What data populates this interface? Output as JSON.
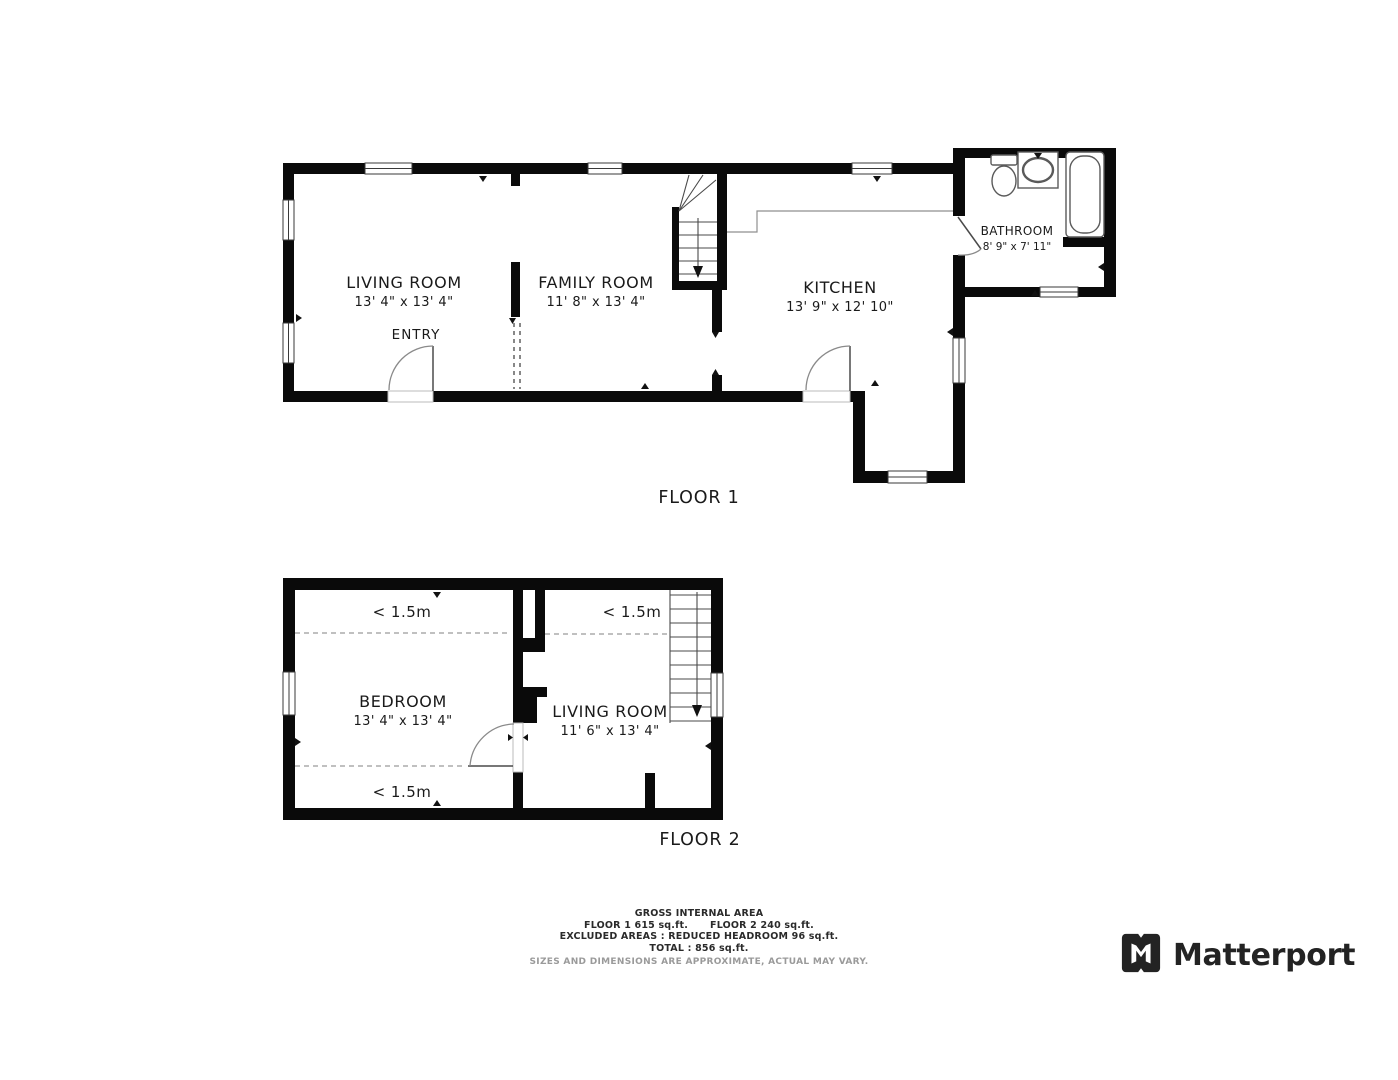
{
  "floor1": {
    "label": "FLOOR 1",
    "rooms": {
      "living_room": {
        "name": "LIVING ROOM",
        "dims": "13' 4\" x 13' 4\""
      },
      "entry": {
        "name": "ENTRY"
      },
      "family_room": {
        "name": "FAMILY ROOM",
        "dims": "11' 8\" x 13' 4\""
      },
      "kitchen": {
        "name": "KITCHEN",
        "dims": "13' 9\" x 12' 10\""
      },
      "bathroom": {
        "name": "BATHROOM",
        "dims": "8' 9\" x 7' 11\""
      }
    }
  },
  "floor2": {
    "label": "FLOOR 2",
    "rooms": {
      "bedroom": {
        "name": "BEDROOM",
        "dims": "13' 4\" x 13' 4\""
      },
      "living_room": {
        "name": "LIVING ROOM",
        "dims": "11' 6\" x 13' 4\""
      }
    },
    "headroom_note": "< 1.5m"
  },
  "footer": {
    "title": "GROSS INTERNAL AREA",
    "floor1_area": "FLOOR 1 615 sq.ft.",
    "floor2_area": "FLOOR 2 240 sq.ft.",
    "excluded": "EXCLUDED AREAS :  REDUCED HEADROOM 96 sq.ft.",
    "total": "TOTAL :  856 sq.ft.",
    "disclaimer": "SIZES AND DIMENSIONS ARE APPROXIMATE, ACTUAL MAY VARY."
  },
  "brand": {
    "name": "Matterport"
  },
  "colors": {
    "wall": "#0a0a0a",
    "text": "#1a1a1a",
    "muted": "#9a9a9a",
    "brand": "#232323"
  }
}
